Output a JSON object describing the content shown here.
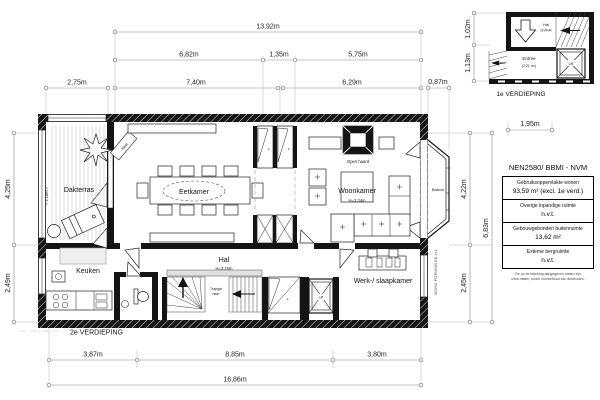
{
  "title": {
    "floor": "2e VERDIEPING",
    "watermark": "WWW.FORMWISE.NL"
  },
  "rooms": {
    "dakterras": "Dakterras",
    "dakterras_width": "< 4,18m >",
    "kast": "Kast",
    "kast_k": "k.",
    "eetkamer": "Eetkamer",
    "woonkamer": "Woonkamer",
    "woonkamer_height": "H=3,34m",
    "open_haard": "Open haard",
    "balkon": "Balkon",
    "keuken": "Keuken",
    "hal": "Hal",
    "hal_height": "H=3,10m",
    "trapgat_line1": "Trapgat",
    "trapgat_line2": "naar",
    "werk_slaapkamer": "Werk-/ slaapkamer",
    "lift": "Lift"
  },
  "dimensions": {
    "top_total": "13,92m",
    "top_row2": [
      "6,82m",
      "1,35m",
      "5,75m"
    ],
    "top_row3": [
      "2,75m",
      "7,40m",
      "6,29m",
      "0,87m"
    ],
    "left": [
      "4,25m",
      "2,49m"
    ],
    "right": [
      "4,22m",
      "2,45m"
    ],
    "right_total": "6,83m",
    "bottom": [
      "3,87m",
      "8,85m",
      "3,80m"
    ],
    "bottom_total": "16,86m"
  },
  "inset": {
    "label": "1e VERDIEPING",
    "hal_line1": "Hal",
    "hal_line2": "GVKR",
    "entree": "Entree",
    "entree_area": "(2,21 m²)",
    "lift": "Lift",
    "dims": {
      "v1": "1,02m",
      "v2": "1,13m",
      "h1": "1,95m"
    }
  },
  "legend": {
    "title": "NEN2580/ BBMI - NVM",
    "rows": [
      {
        "label": "Gebruiksoppervlakte wonen",
        "value": "93,59 m² (excl. 1e verd.)"
      },
      {
        "label": "Overige inpandige ruimte",
        "value": "n.v.t."
      },
      {
        "label": "Gebouwgebonden buitenruimte",
        "value": "13,62 m²"
      },
      {
        "label": "Externe bergruimte",
        "value": "n.v.t."
      }
    ],
    "footnote_line1": "De op de tekening aangegeven maten zijn",
    "footnote_line2": "circa maten, onder voorbehoud van drukfouten."
  }
}
